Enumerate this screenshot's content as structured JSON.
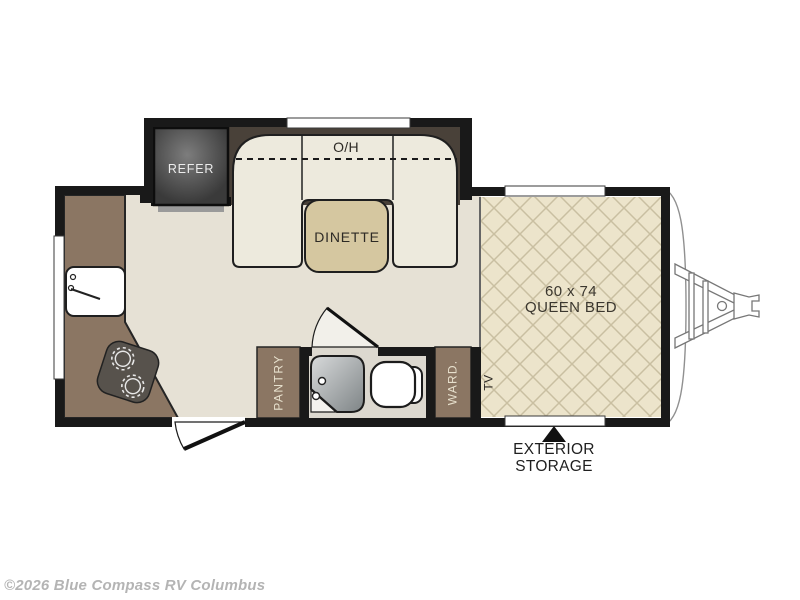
{
  "labels": {
    "refrigerator": "REFER",
    "overhead_cabinet": "O/H",
    "dinette": "DINETTE",
    "pantry": "PANTRY",
    "wardrobe": "WARD.",
    "tv": "TV",
    "bed_size": "60 x 74",
    "bed_name": "QUEEN BED",
    "exterior_storage_line1": "EXTERIOR",
    "exterior_storage_line2": "STORAGE"
  },
  "watermark": {
    "text": "©2026 Blue Compass RV Columbus"
  },
  "colors": {
    "wall": "#191919",
    "floor": "#e6e1d5",
    "counter": "#8b7663",
    "dark_cabinet": "#494139",
    "bench": "#edeadd",
    "table": "#d5c7a0",
    "bed_bg": "#ece4cb",
    "bed_line": "#c9bfa1",
    "bath_floor": "#dcd8cf",
    "appliance_dark": "#57524c",
    "watermark_gray": "#b4b4b4"
  }
}
